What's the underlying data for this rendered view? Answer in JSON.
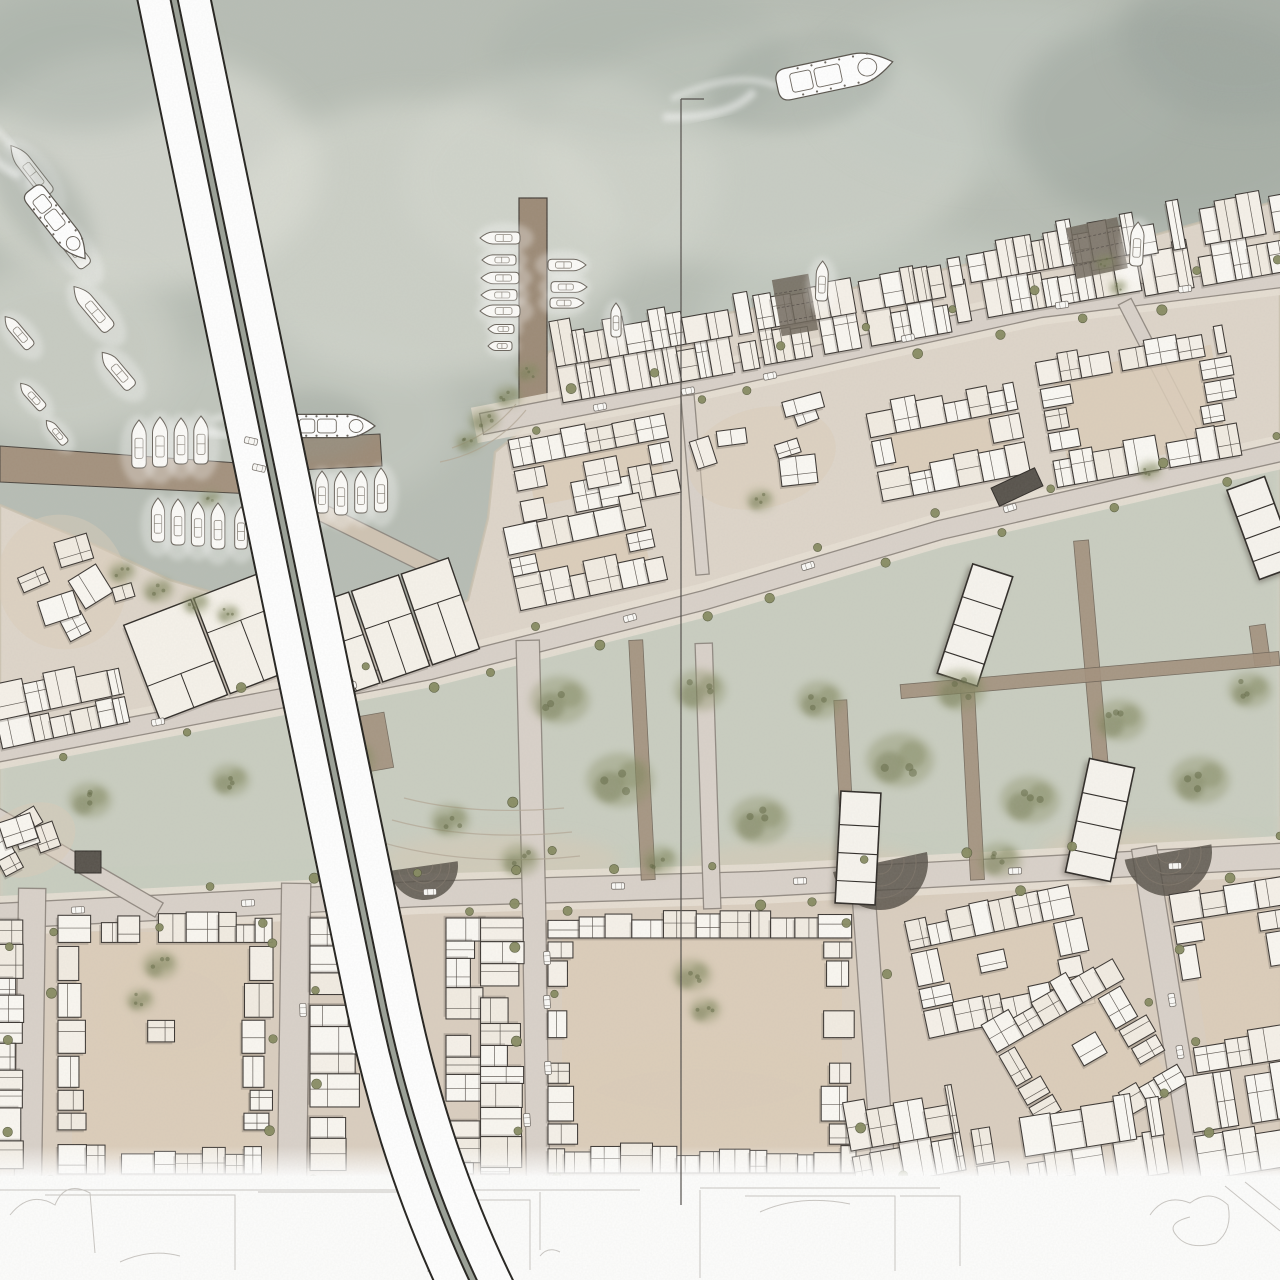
{
  "seed": 11,
  "palette": {
    "water": "#b7bdb4",
    "water_dark": "#97a19a",
    "water_light": "#dfe0d9",
    "land": "#ded5c9",
    "land_lower_tint": "#d8cbba",
    "park": "#c7cdc0",
    "building_fill": "#f9f6f0",
    "building_line": "#3a3531",
    "building_shadow": "#5f574e",
    "courtyard": "#dccdb8",
    "road_fill": "#d9d1c9",
    "road_casing": "#8a827a",
    "sidewalk": "#e7dfd4",
    "pier": "#9c8a76",
    "quay": "#a3917d",
    "walk": "#d3c7b6",
    "tree": "#8a9066",
    "tree_dark": "#747a52",
    "street_tree": "#868a60",
    "bridge_white": "#ffffff",
    "bridge_casing": "#23211d",
    "bridge_median": "#9aa096",
    "amphitheater": "#544e46",
    "ramp": "#6f665a",
    "section_line": "#514d49",
    "sketch_line": "#c3c0bb",
    "car_fill": "#fbfaf7",
    "car_line": "#6e6862"
  },
  "water": {
    "mist": [
      [
        140,
        170,
        180,
        120,
        "#e3e4dc",
        0.55
      ],
      [
        420,
        240,
        200,
        140,
        "#dfe1d8",
        0.5
      ],
      [
        760,
        150,
        220,
        120,
        "#dcdfd6",
        0.45
      ],
      [
        1000,
        90,
        180,
        90,
        "#c3cac2",
        0.5
      ],
      [
        80,
        60,
        120,
        70,
        "#a7b0a8",
        0.5
      ],
      [
        1180,
        120,
        170,
        110,
        "#9ba49c",
        0.55
      ],
      [
        640,
        60,
        150,
        80,
        "#aab3aa",
        0.45
      ],
      [
        300,
        420,
        160,
        90,
        "#cfd3ca",
        0.4
      ],
      [
        900,
        320,
        200,
        90,
        "#ced4cb",
        0.4
      ],
      [
        60,
        350,
        120,
        90,
        "#d8dad1",
        0.5
      ],
      [
        1240,
        40,
        120,
        80,
        "#99a29b",
        0.5
      ],
      [
        560,
        180,
        160,
        110,
        "#d6d9d0",
        0.45
      ]
    ]
  },
  "shore": [
    [
      0,
      505
    ],
    [
      95,
      545
    ],
    [
      170,
      580
    ],
    [
      280,
      612
    ],
    [
      400,
      632
    ],
    [
      468,
      600
    ],
    [
      488,
      518
    ],
    [
      495,
      452
    ],
    [
      522,
      430
    ],
    [
      548,
      352
    ],
    [
      620,
      330
    ],
    [
      700,
      318
    ],
    [
      800,
      300
    ],
    [
      880,
      282
    ],
    [
      1000,
      258
    ],
    [
      1100,
      250
    ],
    [
      1180,
      228
    ],
    [
      1280,
      200
    ],
    [
      1280,
      1280
    ],
    [
      0,
      1280
    ]
  ],
  "park_band": [
    [
      0,
      764
    ],
    [
      430,
      682
    ],
    [
      705,
      612
    ],
    [
      940,
      542
    ],
    [
      1280,
      464
    ],
    [
      1280,
      844
    ],
    [
      760,
      872
    ],
    [
      420,
      882
    ],
    [
      0,
      904
    ]
  ],
  "lower_tint": [
    [
      0,
      872
    ],
    [
      1280,
      816
    ],
    [
      1280,
      1280
    ],
    [
      0,
      1280
    ]
  ],
  "piers": {
    "quay1": [
      [
        0,
        446
      ],
      [
        252,
        464
      ],
      [
        254,
        494
      ],
      [
        0,
        482
      ]
    ],
    "pier_vertical": [
      519,
      198,
      28,
      208
    ],
    "pier3": [
      [
        296,
        438
      ],
      [
        380,
        434
      ],
      [
        382,
        466
      ],
      [
        298,
        470
      ]
    ]
  },
  "ramps": [
    [
      795,
      305,
      37,
      57,
      -10
    ],
    [
      1097,
      248,
      52,
      52,
      -12
    ]
  ],
  "roads": [
    {
      "pts": [
        [
          492,
          422
        ],
        [
          700,
          382
        ],
        [
          1040,
          307
        ],
        [
          1280,
          277
        ]
      ],
      "w": 20,
      "trees": true,
      "gap": 40,
      "sw": true
    },
    {
      "pts": [
        [
          0,
          752
        ],
        [
          430,
          670
        ],
        [
          705,
          600
        ],
        [
          940,
          530
        ],
        [
          1280,
          452
        ]
      ],
      "w": 18,
      "trees": true,
      "gap": 56,
      "sw": true
    },
    {
      "pts": [
        [
          0,
          916
        ],
        [
          420,
          894
        ],
        [
          760,
          884
        ],
        [
          1280,
          856
        ]
      ],
      "w": 24,
      "trees": true,
      "gap": 48,
      "sw": true
    },
    {
      "pts": [
        [
          32,
          902
        ],
        [
          28,
          1178
        ]
      ],
      "w": 26,
      "trees": true,
      "gap": 44,
      "sw": false
    },
    {
      "pts": [
        [
          296,
          898
        ],
        [
          292,
          1178
        ]
      ],
      "w": 28,
      "trees": true,
      "gap": 44,
      "sw": false
    },
    {
      "pts": [
        [
          528,
          652
        ],
        [
          534,
          902
        ],
        [
          538,
          1178
        ]
      ],
      "w": 22,
      "trees": true,
      "gap": 46,
      "sw": false
    },
    {
      "pts": [
        [
          704,
          652
        ],
        [
          712,
          900
        ]
      ],
      "w": 16,
      "trees": false,
      "gap": 0,
      "sw": false
    },
    {
      "pts": [
        [
          862,
          872
        ],
        [
          884,
          1178
        ]
      ],
      "w": 22,
      "trees": true,
      "gap": 46,
      "sw": false
    },
    {
      "pts": [
        [
          1146,
          860
        ],
        [
          1198,
          1182
        ]
      ],
      "w": 24,
      "trees": true,
      "gap": 46,
      "sw": false
    },
    {
      "pts": [
        [
          1128,
          308
        ],
        [
          1200,
          448
        ]
      ],
      "w": 13,
      "trees": false,
      "gap": 0,
      "sw": false
    },
    {
      "pts": [
        [
          688,
          402
        ],
        [
          702,
          568
        ]
      ],
      "w": 12,
      "trees": false,
      "gap": 0,
      "sw": false
    },
    {
      "pts": [
        [
          0,
          818
        ],
        [
          152,
          906
        ]
      ],
      "w": 15,
      "trees": false,
      "gap": 0,
      "sw": false
    },
    {
      "pts": [
        [
          252,
          478
        ],
        [
          430,
          566
        ]
      ],
      "w": 16,
      "trees": false,
      "gap": 0,
      "sw": false,
      "c": "#cfc3b2"
    }
  ],
  "brown_paths": [
    [
      376,
      742,
      26,
      56,
      -10
    ],
    [
      642,
      760,
      14,
      240,
      -3
    ],
    [
      845,
      790,
      13,
      180,
      -3
    ],
    [
      972,
      775,
      14,
      210,
      -3
    ],
    [
      1095,
      700,
      15,
      320,
      -5
    ],
    [
      1260,
      645,
      16,
      40,
      -8
    ],
    [
      1090,
      675,
      380,
      14,
      -5
    ]
  ],
  "blocks": [
    [
      655,
      348,
      200,
      76,
      -10,
      "dense"
    ],
    [
      852,
      312,
      190,
      74,
      -10,
      "dense"
    ],
    [
      1045,
      268,
      190,
      78,
      -10,
      "dense"
    ],
    [
      1222,
      240,
      170,
      84,
      -10,
      "dense"
    ],
    [
      595,
      468,
      160,
      80,
      -11,
      "peri"
    ],
    [
      585,
      552,
      150,
      88,
      -12,
      "peri"
    ],
    [
      762,
      458,
      150,
      100,
      -14,
      "scatter"
    ],
    [
      948,
      442,
      150,
      92,
      -11,
      "peri"
    ],
    [
      1140,
      408,
      190,
      128,
      -10,
      "peri"
    ],
    [
      212,
      646,
      150,
      102,
      -21,
      "big"
    ],
    [
      392,
      628,
      158,
      96,
      -19,
      "big"
    ],
    [
      62,
      582,
      128,
      136,
      -24,
      "scatter"
    ],
    [
      60,
      706,
      130,
      60,
      -12,
      "rows"
    ],
    [
      30,
      840,
      95,
      70,
      -26,
      "scatter"
    ],
    [
      9,
      1046,
      252,
      20,
      90,
      "rows"
    ],
    [
      166,
      1046,
      216,
      256,
      0,
      "peri"
    ],
    [
      330,
      1046,
      256,
      40,
      90,
      "rows"
    ],
    [
      482,
      1046,
      256,
      72,
      90,
      "rows"
    ],
    [
      702,
      1044,
      308,
      258,
      0,
      "peri"
    ],
    [
      1000,
      962,
      170,
      120,
      -12,
      "peri"
    ],
    [
      1085,
      1055,
      150,
      150,
      -30,
      "peri"
    ],
    [
      1240,
      975,
      115,
      180,
      -9,
      "peri"
    ],
    [
      1070,
      1148,
      190,
      80,
      -9,
      "rows"
    ],
    [
      1248,
      1122,
      110,
      100,
      -9,
      "rows"
    ],
    [
      905,
      1140,
      110,
      80,
      -10,
      "rows"
    ]
  ],
  "towers": [
    [
      858,
      848,
      40,
      112,
      3
    ],
    [
      1100,
      820,
      46,
      116,
      12
    ],
    [
      975,
      625,
      42,
      115,
      18
    ],
    [
      1262,
      528,
      40,
      95,
      -20
    ]
  ],
  "dark_buildings": [
    [
      1017,
      487,
      48,
      20,
      -25
    ],
    [
      88,
      862,
      26,
      22,
      0
    ]
  ],
  "amphitheaters": [
    [
      880,
      862,
      48,
      -12
    ],
    [
      1168,
      852,
      44,
      -10
    ],
    [
      424,
      866,
      34,
      -8
    ]
  ],
  "terraces": [
    "M380,842 q90,26 200,14",
    "M392,820 q80,22 180,12",
    "M404,798 q70,18 160,10",
    "M452,448 q40,-14 64,-44",
    "M440,462 q52,-10 86,-52"
  ],
  "tan_patches": [
    [
      500,
      860,
      120,
      26
    ],
    [
      800,
      868,
      120,
      26
    ],
    [
      1150,
      850,
      110,
      24
    ],
    [
      880,
      880,
      70,
      20
    ],
    [
      1120,
      862,
      70,
      20
    ],
    [
      700,
      1090,
      130,
      40
    ],
    [
      180,
      1010,
      70,
      60
    ]
  ],
  "park_trees": [
    [
      484,
      420,
      16
    ],
    [
      508,
      396,
      14
    ],
    [
      528,
      372,
      12
    ],
    [
      468,
      442,
      13
    ],
    [
      122,
      572,
      14
    ],
    [
      158,
      590,
      16
    ],
    [
      196,
      603,
      14
    ],
    [
      228,
      614,
      12
    ],
    [
      350,
      760,
      26
    ],
    [
      450,
      820,
      20
    ],
    [
      560,
      700,
      30
    ],
    [
      620,
      780,
      34
    ],
    [
      700,
      690,
      26
    ],
    [
      760,
      820,
      30
    ],
    [
      820,
      700,
      24
    ],
    [
      900,
      760,
      34
    ],
    [
      960,
      690,
      26
    ],
    [
      1030,
      800,
      30
    ],
    [
      1120,
      720,
      26
    ],
    [
      1200,
      780,
      30
    ],
    [
      1250,
      690,
      22
    ],
    [
      520,
      860,
      20
    ],
    [
      1000,
      860,
      22
    ],
    [
      660,
      860,
      18
    ],
    [
      90,
      800,
      22
    ],
    [
      230,
      780,
      20
    ],
    [
      160,
      965,
      18
    ],
    [
      140,
      1000,
      14
    ],
    [
      692,
      975,
      20
    ],
    [
      705,
      1010,
      16
    ],
    [
      210,
      500,
      12
    ],
    [
      760,
      500,
      14
    ],
    [
      1150,
      470,
      12
    ],
    [
      1105,
      262,
      10
    ],
    [
      1118,
      287,
      9
    ]
  ],
  "cars": [
    [
      600,
      407,
      -11
    ],
    [
      688,
      391,
      -11
    ],
    [
      770,
      376,
      -12
    ],
    [
      908,
      338,
      -12
    ],
    [
      1062,
      305,
      -8
    ],
    [
      1185,
      289,
      -8
    ],
    [
      158,
      722,
      -11
    ],
    [
      350,
      686,
      -14
    ],
    [
      630,
      618,
      -15
    ],
    [
      808,
      566,
      -17
    ],
    [
      1010,
      508,
      -17
    ],
    [
      78,
      910,
      -3
    ],
    [
      248,
      903,
      -3
    ],
    [
      430,
      892,
      -2
    ],
    [
      618,
      886,
      -1
    ],
    [
      800,
      881,
      -2
    ],
    [
      1015,
      871,
      -2
    ],
    [
      1175,
      866,
      -2
    ],
    [
      547,
      958,
      86
    ],
    [
      547,
      1002,
      86
    ],
    [
      548,
      1068,
      86
    ],
    [
      527,
      1120,
      86
    ],
    [
      1172,
      1000,
      80
    ],
    [
      1180,
      1052,
      80
    ],
    [
      303,
      1010,
      88
    ]
  ],
  "bridge": {
    "path": "M168,-30 L383,1008 Q421,1186 498,1330",
    "casing_w": 74,
    "deck_w": 70,
    "median_casing_w": 9,
    "median_w": 5,
    "cars": [
      [
        251,
        441,
        13
      ],
      [
        259,
        468,
        13
      ]
    ]
  },
  "boats": [
    [
      30,
      170,
      -38,
      62
    ],
    [
      66,
      240,
      -38,
      66
    ],
    [
      92,
      308,
      -40,
      56
    ],
    [
      117,
      370,
      -40,
      46
    ],
    [
      18,
      332,
      -40,
      40
    ],
    [
      32,
      396,
      -42,
      34
    ],
    [
      56,
      432,
      -40,
      30
    ],
    [
      139,
      444,
      0,
      48
    ],
    [
      160,
      442,
      0,
      50
    ],
    [
      181,
      441,
      0,
      46
    ],
    [
      201,
      440,
      0,
      48
    ],
    [
      158,
      520,
      0,
      44
    ],
    [
      178,
      522,
      0,
      46
    ],
    [
      198,
      524,
      0,
      44
    ],
    [
      218,
      526,
      0,
      46
    ],
    [
      241,
      528,
      0,
      42
    ],
    [
      322,
      492,
      0,
      42
    ],
    [
      341,
      493,
      0,
      44
    ],
    [
      361,
      492,
      0,
      42
    ],
    [
      381,
      490,
      0,
      44
    ],
    [
      500,
      238,
      -90,
      40
    ],
    [
      499,
      260,
      -90,
      34
    ],
    [
      500,
      278,
      -90,
      38
    ],
    [
      499,
      295,
      -90,
      36
    ],
    [
      500,
      311,
      -90,
      40
    ],
    [
      501,
      329,
      -90,
      26
    ],
    [
      500,
      346,
      -90,
      24
    ],
    [
      567,
      265,
      90,
      38
    ],
    [
      569,
      287,
      90,
      36
    ],
    [
      567,
      303,
      90,
      34
    ],
    [
      616,
      320,
      0,
      34
    ],
    [
      1137,
      244,
      3,
      44
    ],
    [
      822,
      281,
      2,
      40
    ]
  ],
  "ships": [
    {
      "x": 835,
      "y": 74,
      "rot": 78,
      "len": 118
    },
    {
      "x": 58,
      "y": 224,
      "rot": 142,
      "len": 88
    },
    {
      "x": 332,
      "y": 426,
      "rot": 90,
      "len": 86
    }
  ],
  "section_line": {
    "x": 681,
    "y1": 99,
    "y2": 1205,
    "tick_x2": 704
  },
  "sketch": {
    "strip_y": 1176,
    "lines": [
      "M10,1215 q20,-25 45,-10 q10,-25 35,-12 l5,60",
      "M45,1195 h190 v75",
      "M258,1192 h170 v80",
      "M470,1200 h60 v70",
      "M745,1196 h150 v75",
      "M760,1212 q40,-18 90,-8",
      "M900,1196 h60 v70",
      "M1225,1186 l55,45",
      "M1245,1182 l35,28",
      "M0,1190 h640",
      "M700,1188 h240",
      "M1150,1215 q15,-22 40,-12 q20,-15 38,2 q5,25 -12,38 q-28,8 -40,-8 q-10,-12 14,-18",
      "M540,1256 q8,-10 20,-4",
      "M120,1262 q30,-14 60,-6",
      "M700,1190 v88",
      "M540,1192 v58"
    ]
  }
}
